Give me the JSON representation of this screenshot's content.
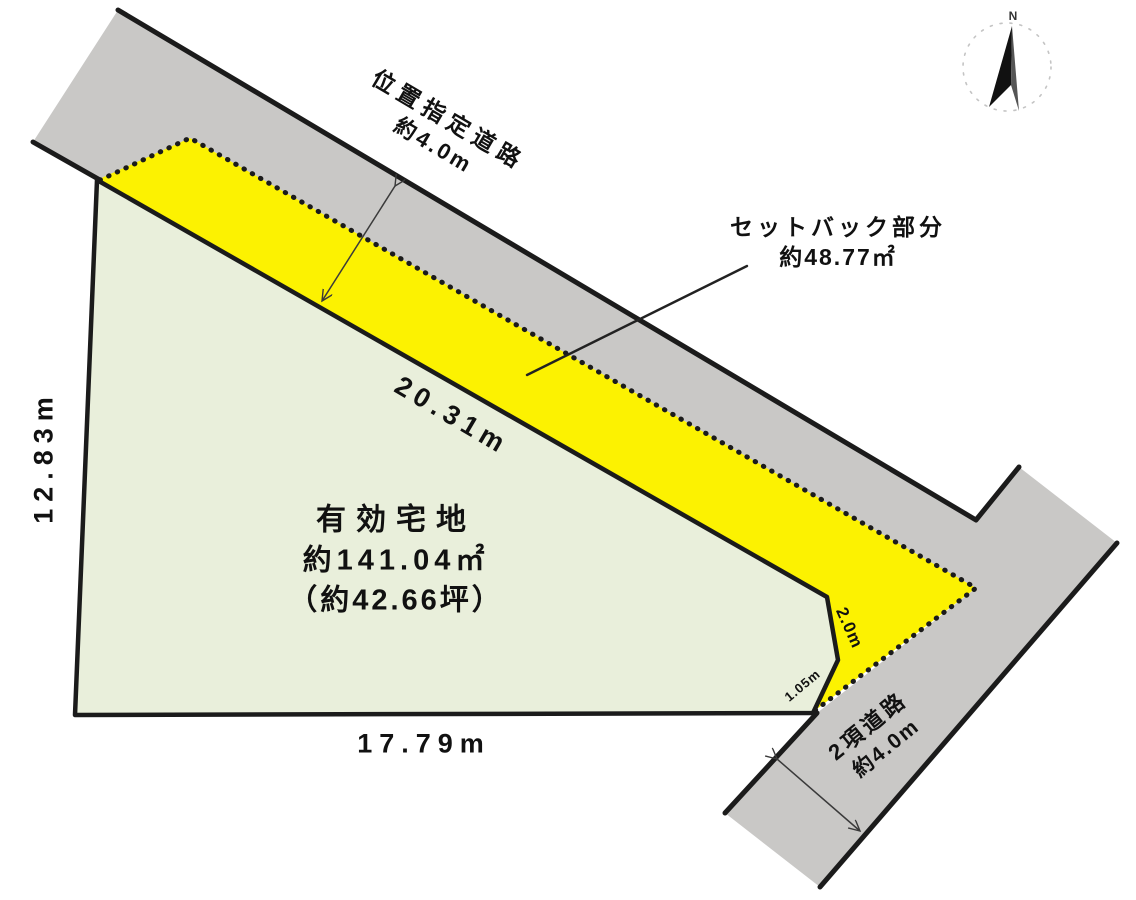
{
  "diagram": {
    "compass": {
      "north_label": "N"
    },
    "roads": {
      "top": {
        "name": "位置指定道路",
        "width": "約4.0m"
      },
      "bottom": {
        "name": "2項道路",
        "width": "約4.0m"
      }
    },
    "setback": {
      "name": "セットバック部分",
      "area": "約48.77㎡"
    },
    "plot": {
      "name": "有効宅地",
      "area_m2": "約141.04㎡",
      "area_tsubo": "（約42.66坪）"
    },
    "dimensions": {
      "top_edge": "20.31m",
      "left_edge": "12.83m",
      "bottom_edge": "17.79m",
      "right_upper_edge": "2.0m",
      "right_bevel_edge": "1.05m"
    },
    "colors": {
      "road_fill": "#c9c8c6",
      "setback_fill": "#fcf201",
      "plot_fill": "#e9efdb",
      "outline": "#1b1b1b",
      "arrow": "#3a3a3a",
      "compass_circle": "#c4c4c4",
      "needle_dark": "#111111",
      "needle_shade": "#555555"
    }
  }
}
